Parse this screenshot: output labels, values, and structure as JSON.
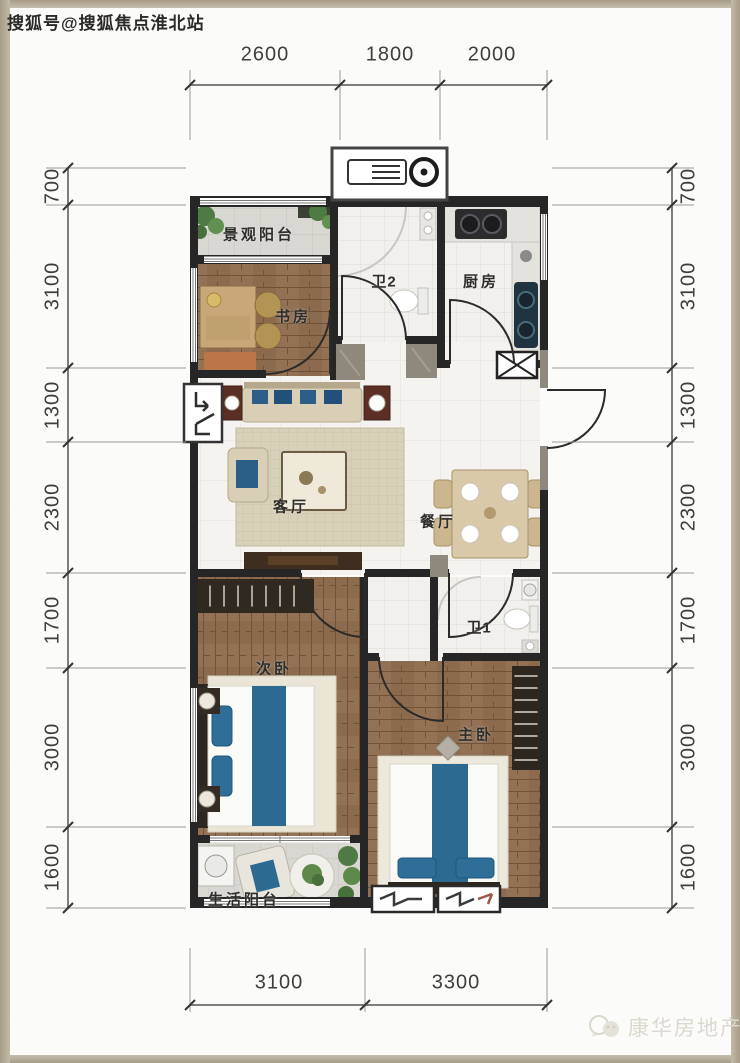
{
  "watermarks": {
    "top_left": "搜狐号@搜狐焦点淮北站",
    "bottom_right": "康华房地产"
  },
  "dimensions": {
    "top": [
      "2600",
      "1800",
      "2000"
    ],
    "bottom": [
      "3100",
      "3300"
    ],
    "left": [
      "700",
      "3100",
      "1300",
      "2300",
      "1700",
      "3000",
      "1600"
    ],
    "right": [
      "700",
      "3100",
      "1300",
      "2300",
      "1700",
      "3000",
      "1600"
    ]
  },
  "rooms": {
    "view_balcony": "景观阳台",
    "study": "书房",
    "bath2": "卫2",
    "kitchen": "厨房",
    "living": "客厅",
    "dining": "餐厅",
    "bedroom2": "次卧",
    "bath1": "卫1",
    "master": "主卧",
    "life_balcony": "生活阳台"
  },
  "colors": {
    "frame": "#b2a892",
    "wall": "#262626",
    "wood_floor": "#8b6a4d",
    "accent_blue": "#2c6a92",
    "dim_text": "#3e3e3e"
  }
}
